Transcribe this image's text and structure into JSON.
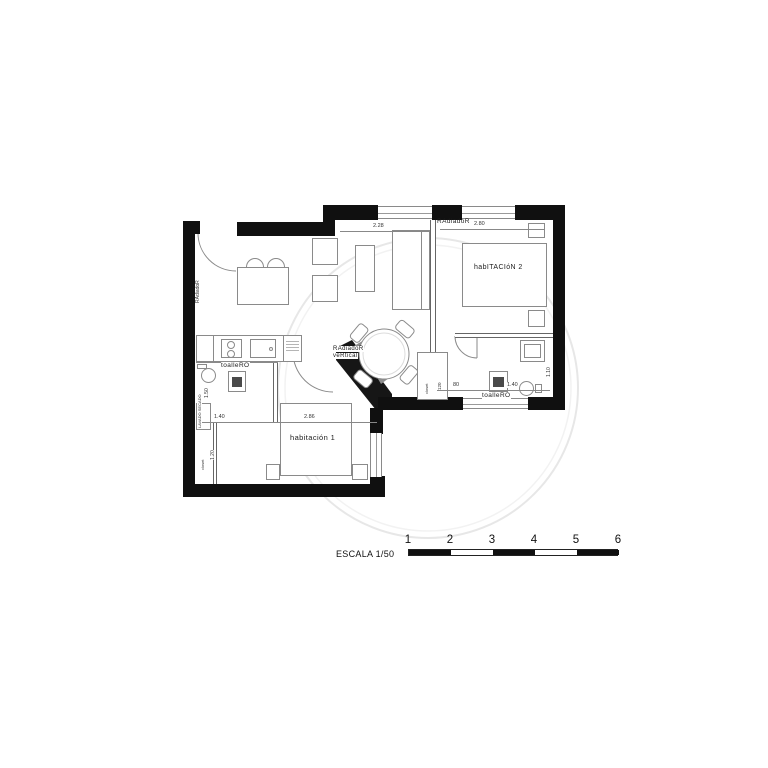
{
  "plan": {
    "labels": {
      "radiator_top": "RAdiadoR",
      "radiator_left": "RAdiadoR",
      "radiator_vertical_1": "RAdiadoR",
      "radiator_vertical_2": "veRtical",
      "room2": "habITACIóN 2",
      "room1": "habitación  1",
      "towel_rail_bath1": "toalleRO",
      "towel_rail_bath2": "toalleRO",
      "laundry": "LAVADO SECADO",
      "closet_room1": "closet",
      "hall_cabinet": "closet"
    },
    "dims": {
      "living_window": "2.28",
      "room2_window": "2.80",
      "room1_width": "2.86",
      "bath1_width": "1.40",
      "bath1_depth": "1.50",
      "closet_width": "1.20",
      "hall_width": "80",
      "bath2_width": "1.40",
      "bath2_depth": "1.10",
      "hall_cabinet_width": "120"
    }
  },
  "scale_bar": {
    "label": "ESCALA 1/50",
    "ticks": [
      "1",
      "2",
      "3",
      "4",
      "5",
      "6"
    ]
  }
}
